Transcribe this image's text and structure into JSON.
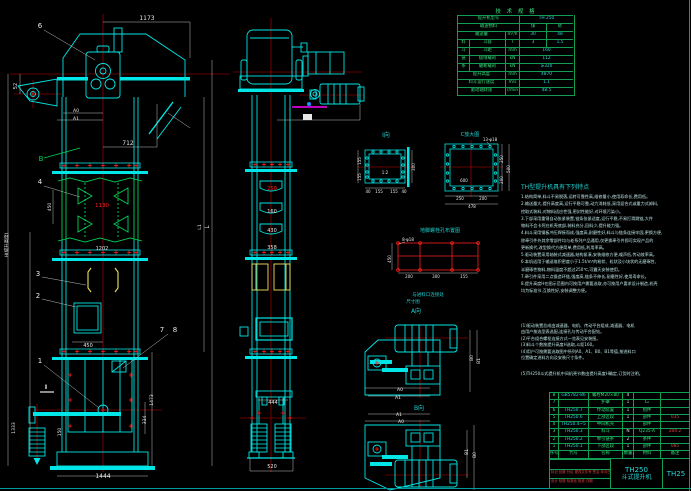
{
  "colors": {
    "background": "#000000",
    "cyan": "#00e5e5",
    "bright_cyan": "#00ffff",
    "green": "#00d455",
    "red": "#ff1e1e",
    "yellow": "#f2e25a",
    "magenta": "#ff00ff",
    "white": "#e8e8e8",
    "table_green": "#129e52"
  },
  "spec_table": {
    "title": "技 术 规 格",
    "rows": [
      [
        {
          "t": "提升机型号",
          "w": 62
        },
        {
          "t": "TH 250",
          "w": 54,
          "c": "cc"
        }
      ],
      [
        {
          "t": "输送物料",
          "w": 62
        },
        {
          "t": "煤",
          "w": 27
        },
        {
          "t": "砂",
          "w": 27
        }
      ],
      [
        {
          "t": "输送量",
          "w": 48
        },
        {
          "t": "m³/h",
          "w": 14
        },
        {
          "t": "30",
          "w": 27,
          "c": "cc"
        },
        {
          "t": "48",
          "w": 27,
          "c": "cc"
        }
      ],
      [
        {
          "t": "料",
          "w": 12
        },
        {
          "t": "斗容",
          "w": 36
        },
        {
          "t": "l",
          "w": 14
        },
        {
          "t": "3",
          "w": 27,
          "c": "cc"
        },
        {
          "t": "1.5",
          "w": 27,
          "c": "cc"
        }
      ],
      [
        {
          "t": "斗",
          "w": 12
        },
        {
          "t": "斗距",
          "w": 36
        },
        {
          "t": "mm",
          "w": 14
        },
        {
          "t": "160",
          "w": 54,
          "c": "cc"
        }
      ],
      [
        {
          "t": "链",
          "w": 12
        },
        {
          "t": "极限载荷",
          "w": 36
        },
        {
          "t": "kN",
          "w": 14
        },
        {
          "t": "112",
          "w": 54,
          "c": "cc"
        }
      ],
      [
        {
          "t": "条",
          "w": 12
        },
        {
          "t": "破断载荷",
          "w": 36
        },
        {
          "t": "kN",
          "w": 14
        },
        {
          "t": "≥320",
          "w": 54,
          "c": "cc"
        }
      ],
      [
        {
          "t": "提升高度",
          "w": 48
        },
        {
          "t": "mm",
          "w": 14
        },
        {
          "t": "4870",
          "w": 54,
          "c": "cc"
        }
      ],
      [
        {
          "t": "料斗运行速度",
          "w": 48
        },
        {
          "t": "m/s",
          "w": 14
        },
        {
          "t": "1.1",
          "w": 54,
          "c": "cc"
        }
      ],
      [
        {
          "t": "驱动轴转速",
          "w": 48
        },
        {
          "t": "r/min",
          "w": 14
        },
        {
          "t": "48.5",
          "w": 54,
          "c": "cc"
        }
      ]
    ]
  },
  "features": {
    "title": "TH型提升机具有下列特点",
    "lines": [
      "1.结构简单,料斗不易脱落,运转可靠性高,维修量小,使用寿命长,费用低。",
      "2.输送量大,提升高度高,运行平稳可靠,动力消耗低,采用混合式或重力式卸料,",
      "  挖取式装料,对物料适应性强,密封性能好,对环境污染小。",
      "3.下部采用重锤自动张紧装置,链条张紧适度,运行平稳,不易打滑跳链,大件",
      "  物料不会卡死在机壳底部,装料充分,回料少,提升能力强。",
      "4.料斗采用钢板冲压焊接而成,强度高,耐磨性好,料斗与链条连接牢固,更换方便,",
      "  除牵引件外其余零部件均与老系列产品通用,仅更换牵引件即可实现产品的",
      "  更新换代,改型换代方便简单,费用低,利用率高。",
      "5.驱动装置采用轴装式减速器,结构紧凑,安装维修方便,噪声低,传动效率高。",
      "6.本机适用于输送堆积密度小于1.5t/m³的粉状、粒状及小块状的无磨琢性、",
      "  半磨琢性物料,物料温度不超过250℃,可露天安装使用。",
      "7.牵引件采用二点锻造环链,强度高,链条不伸长,耐磨性好,使用寿命长。",
      "8.提升高度H在图示范围内可按用户需要选取,亦可按用户要求设计制造,机壳",
      "  均为标准节,互换性好,安装调整方便。"
    ]
  },
  "notes": {
    "lines": [
      "(1)驱动装置总成由减速器、电机、传动平台组成,减速器、电机",
      "  由用户按选型表选配,连接孔与传动平台配钻。",
      "(2)平台组合螺栓连接方式一览表见安装图。",
      "(3)料斗个数按提升高度H选取,斗距160。",
      "(4)用户可按需要选取图中所列A0、A1、B0、B1等值,按进料口",
      "  位置确定进料方向及安装尺寸条件。"
    ],
    "footer": "(5)TH250斗式提升机中间机壳节数由提升高度H确定,订货时注明。"
  },
  "parts_table": {
    "col_widths": [
      9,
      30,
      34,
      11,
      27,
      29
    ],
    "header": [
      "序号",
      "代号",
      "名称",
      "数量",
      "材料",
      "备注"
    ],
    "rows": [
      {
        "cells": [
          "8",
          "GB5782-86",
          "螺栓M20×80",
          "4",
          "",
          ""
        ],
        "colors": [
          "cg",
          "cc",
          "cg",
          "cw",
          "cg",
          "cr"
        ]
      },
      {
        "cells": [
          "7",
          "",
          "护罩",
          "1",
          "L₀",
          ""
        ],
        "colors": [
          "cg",
          "cc",
          "cg",
          "cw",
          "cg",
          "cr"
        ]
      },
      {
        "cells": [
          "6",
          "TH250.7",
          "传动装置",
          "1",
          "组件",
          ""
        ],
        "colors": [
          "cg",
          "cc",
          "cg",
          "cw",
          "cg",
          "cr"
        ]
      },
      {
        "cells": [
          "5",
          "TH250.6",
          "上部区段",
          "1",
          "部件",
          "035"
        ],
        "colors": [
          "cg",
          "cc",
          "cg",
          "cw",
          "cg",
          "cr"
        ]
      },
      {
        "cells": [
          "4",
          "TH250.4~5",
          "中间机壳",
          "",
          "部件",
          ""
        ],
        "colors": [
          "cg",
          "cc",
          "cg",
          "cw",
          "cg",
          "cr"
        ]
      },
      {
        "cells": [
          "3",
          "TH250.3",
          "料斗",
          "N",
          "Q235-A",
          "204 2"
        ],
        "colors": [
          "cg",
          "cc",
          "cg",
          "cw",
          "cg",
          "cr"
        ]
      },
      {
        "cells": [
          "2",
          "TH250.2",
          "牵引链条",
          "2",
          "条件",
          ""
        ],
        "colors": [
          "cg",
          "cc",
          "cg",
          "cw",
          "cg",
          "cr"
        ]
      },
      {
        "cells": [
          "1",
          "TH250.1",
          "下部区段",
          "1",
          "部件",
          "085"
        ],
        "colors": [
          "cg",
          "cc",
          "cg",
          "cw",
          "cg",
          "cr"
        ]
      }
    ]
  },
  "title_block": {
    "model": "TH250",
    "name": "斗式提升机",
    "drawing_no": "TH25",
    "rev_row": "标记 处数 分区 更改文件号 签名 年月日",
    "sign_row": "设计  校核  标准化  批准  日期"
  },
  "labels": [
    {
      "n": "dim-1173",
      "t": "1173",
      "x": 147,
      "y": 20,
      "c": "#e8e8e8",
      "s": 6
    },
    {
      "n": "leader-6-label",
      "t": "6",
      "x": 40,
      "y": 28,
      "c": "#e8e8e8",
      "s": 7
    },
    {
      "n": "dim-52",
      "t": "52",
      "x": 17,
      "y": 86,
      "c": "#e8e8e8",
      "s": 5,
      "r": -90
    },
    {
      "n": "dim-a0-head",
      "t": "A0",
      "x": 76,
      "y": 112,
      "c": "#e8e8e8",
      "s": 4.5
    },
    {
      "n": "dim-a1-head",
      "t": "A1",
      "x": 76,
      "y": 120,
      "c": "#e8e8e8",
      "s": 4.5
    },
    {
      "n": "dim-712",
      "t": "712",
      "x": 128,
      "y": 145,
      "c": "#e8e8e8",
      "s": 6
    },
    {
      "n": "label-b-section",
      "t": "B",
      "x": 41,
      "y": 161,
      "c": "#00d455",
      "s": 7
    },
    {
      "n": "leader-4-label",
      "t": "4",
      "x": 40,
      "y": 184,
      "c": "#e8e8e8",
      "s": 7
    },
    {
      "n": "dim-450-bucket",
      "t": "450",
      "x": 51,
      "y": 207,
      "c": "#e8e8e8",
      "s": 4.5,
      "r": -90
    },
    {
      "n": "dim-1130",
      "t": "1130",
      "x": 102,
      "y": 207,
      "c": "#ff1e1e",
      "s": 5.5
    },
    {
      "n": "dim-1202",
      "t": "1202",
      "x": 102,
      "y": 250,
      "c": "#e8e8e8",
      "s": 5
    },
    {
      "n": "leader-3-label",
      "t": "3",
      "x": 38,
      "y": 276,
      "c": "#e8e8e8",
      "s": 7
    },
    {
      "n": "leader-2-label",
      "t": "2",
      "x": 38,
      "y": 298,
      "c": "#e8e8e8",
      "s": 7
    },
    {
      "n": "dim-450-door",
      "t": "450",
      "x": 88,
      "y": 347,
      "c": "#e8e8e8",
      "s": 5
    },
    {
      "n": "leader-7-label",
      "t": "7",
      "x": 162,
      "y": 332,
      "c": "#e8e8e8",
      "s": 7
    },
    {
      "n": "leader-8-label",
      "t": "8",
      "x": 175,
      "y": 332,
      "c": "#e8e8e8",
      "s": 7
    },
    {
      "n": "leader-1-label",
      "t": "1",
      "x": 40,
      "y": 363,
      "c": "#e8e8e8",
      "s": 7
    },
    {
      "n": "section-ii-label",
      "t": "Ⅱ",
      "x": 46,
      "y": 389,
      "c": "#e8e8e8",
      "s": 6
    },
    {
      "n": "dim-height-h",
      "t": "H(提升高度)",
      "x": 8,
      "y": 245,
      "c": "#e8e8e8",
      "s": 4.5,
      "r": -90
    },
    {
      "n": "dim-1333",
      "t": "1333",
      "x": 15,
      "y": 428,
      "c": "#e8e8e8",
      "s": 4.5,
      "r": -90
    },
    {
      "n": "dim-150",
      "t": "150",
      "x": 61,
      "y": 432,
      "c": "#e8e8e8",
      "s": 4.5,
      "r": -90
    },
    {
      "n": "dim-1473",
      "t": "1473",
      "x": 153,
      "y": 400,
      "c": "#e8e8e8",
      "s": 4.5,
      "r": -90
    },
    {
      "n": "dim-334",
      "t": "334",
      "x": 146,
      "y": 420,
      "c": "#e8e8e8",
      "s": 4.5,
      "r": -90
    },
    {
      "n": "dim-1444",
      "t": "1444",
      "x": 103,
      "y": 478,
      "c": "#e8e8e8",
      "s": 6
    },
    {
      "n": "dim-l-right",
      "t": "L",
      "x": 209,
      "y": 227,
      "c": "#e8e8e8",
      "s": 6,
      "r": -90
    },
    {
      "n": "dim-l1-right",
      "t": "L1",
      "x": 201,
      "y": 227,
      "c": "#e8e8e8",
      "s": 4.5,
      "r": -90
    },
    {
      "n": "dim-250-side",
      "t": "250",
      "x": 272,
      "y": 190,
      "c": "#ff1e1e",
      "s": 5
    },
    {
      "n": "dim-160-side",
      "t": "160",
      "x": 272,
      "y": 213,
      "c": "#e8e8e8",
      "s": 5
    },
    {
      "n": "dim-430-side",
      "t": "430",
      "x": 272,
      "y": 232,
      "c": "#e8e8e8",
      "s": 5
    },
    {
      "n": "dim-358-side",
      "t": "358",
      "x": 272,
      "y": 249,
      "c": "#e8e8e8",
      "s": 5
    },
    {
      "n": "dim-444-side",
      "t": "444",
      "x": 273,
      "y": 404,
      "c": "#e8e8e8",
      "s": 5
    },
    {
      "n": "dim-520-side",
      "t": "520",
      "x": 272,
      "y": 468,
      "c": "#e8e8e8",
      "s": 5
    },
    {
      "n": "view-i-label",
      "t": "Ⅰ向",
      "x": 386,
      "y": 137,
      "c": "#1fd3d3",
      "s": 6
    },
    {
      "n": "view-i-scale",
      "t": "1:2",
      "x": 385,
      "y": 174,
      "c": "#e8e8e8",
      "s": 4
    },
    {
      "n": "dim-155-i-left-a",
      "t": "155",
      "x": 361,
      "y": 161,
      "c": "#e8e8e8",
      "s": 4,
      "r": -90
    },
    {
      "n": "dim-155-i-left-b",
      "t": "155",
      "x": 361,
      "y": 177,
      "c": "#e8e8e8",
      "s": 4,
      "r": -90
    },
    {
      "n": "dim-300-i-right",
      "t": "300",
      "x": 415,
      "y": 167,
      "c": "#e8e8e8",
      "s": 4,
      "r": -90
    },
    {
      "n": "dim-40-i-a",
      "t": "40",
      "x": 368,
      "y": 193,
      "c": "#e8e8e8",
      "s": 4
    },
    {
      "n": "dim-155-i-ba",
      "t": "155",
      "x": 379,
      "y": 193,
      "c": "#e8e8e8",
      "s": 4
    },
    {
      "n": "dim-155-i-bb",
      "t": "155",
      "x": 394,
      "y": 193,
      "c": "#e8e8e8",
      "s": 4
    },
    {
      "n": "dim-40-i-b",
      "t": "40",
      "x": 404,
      "y": 193,
      "c": "#e8e8e8",
      "s": 4
    },
    {
      "n": "view-c-label",
      "t": "C放大图",
      "x": 470,
      "y": 136,
      "c": "#1fd3d3",
      "s": 5
    },
    {
      "n": "label-13-phi18",
      "t": "13-φ18",
      "x": 490,
      "y": 141,
      "c": "#e8e8e8",
      "s": 4
    },
    {
      "n": "dim-600-c",
      "t": "600",
      "x": 464,
      "y": 182,
      "c": "#e8e8e8",
      "s": 4
    },
    {
      "n": "dim-250-c-bottom",
      "t": "250",
      "x": 460,
      "y": 200,
      "c": "#e8e8e8",
      "s": 4
    },
    {
      "n": "dim-200-c-bottom",
      "t": "200",
      "x": 483,
      "y": 200,
      "c": "#e8e8e8",
      "s": 4
    },
    {
      "n": "dim-478-c",
      "t": "478",
      "x": 472,
      "y": 208,
      "c": "#e8e8e8",
      "s": 4
    },
    {
      "n": "dim-250-c-right",
      "t": "250",
      "x": 503,
      "y": 159,
      "c": "#e8e8e8",
      "s": 4,
      "r": -90
    },
    {
      "n": "dim-200-c-right",
      "t": "200",
      "x": 503,
      "y": 180,
      "c": "#e8e8e8",
      "s": 4,
      "r": -90
    },
    {
      "n": "dim-500-c-right",
      "t": "500",
      "x": 510,
      "y": 169,
      "c": "#e8e8e8",
      "s": 4,
      "r": -90
    },
    {
      "n": "anchor-grid-title",
      "t": "地脚螺栓孔布置图",
      "x": 440,
      "y": 232,
      "c": "#1fd3d3",
      "s": 5
    },
    {
      "n": "label-8-phi18",
      "t": "8-φ18",
      "x": 408,
      "y": 241,
      "c": "#e8e8e8",
      "s": 4
    },
    {
      "n": "dim-450-grid",
      "t": "450",
      "x": 391,
      "y": 259,
      "c": "#e8e8e8",
      "s": 4,
      "r": -90
    },
    {
      "n": "dim-200-grid-a",
      "t": "200",
      "x": 409,
      "y": 278,
      "c": "#e8e8e8",
      "s": 4
    },
    {
      "n": "dim-300-grid",
      "t": "300",
      "x": 436,
      "y": 278,
      "c": "#e8e8e8",
      "s": 4
    },
    {
      "n": "dim-155-grid",
      "t": "155",
      "x": 464,
      "y": 278,
      "c": "#e8e8e8",
      "s": 4
    },
    {
      "n": "connect-label-line1",
      "t": "与进料口连接处",
      "x": 428,
      "y": 296,
      "c": "#1fd3d3",
      "s": 4.5
    },
    {
      "n": "connect-label-line2",
      "t": "尺寸图",
      "x": 413,
      "y": 303,
      "c": "#1fd3d3",
      "s": 4.5
    },
    {
      "n": "view-a-label",
      "t": "A向",
      "x": 416,
      "y": 313,
      "c": "#1fd3d3",
      "s": 6
    },
    {
      "n": "view-b-label",
      "t": "B向",
      "x": 419,
      "y": 410,
      "c": "#1fd3d3",
      "s": 6
    },
    {
      "n": "dim-b0-plan-top",
      "t": "B0",
      "x": 473,
      "y": 358,
      "c": "#e8e8e8",
      "s": 4.5,
      "r": -90
    },
    {
      "n": "dim-b1-plan-top",
      "t": "B1",
      "x": 480,
      "y": 361,
      "c": "#e8e8e8",
      "s": 4.5,
      "r": -90
    },
    {
      "n": "dim-a0-plan-top",
      "t": "A0",
      "x": 400,
      "y": 391,
      "c": "#e8e8e8",
      "s": 4.5
    },
    {
      "n": "dim-a1-plan-top",
      "t": "A1",
      "x": 398,
      "y": 399,
      "c": "#e8e8e8",
      "s": 4.5
    },
    {
      "n": "dim-a1-plan-bot",
      "t": "A1",
      "x": 399,
      "y": 416,
      "c": "#e8e8e8",
      "s": 4.5
    },
    {
      "n": "dim-a0-plan-bot",
      "t": "A0",
      "x": 401,
      "y": 423,
      "c": "#e8e8e8",
      "s": 4.5
    },
    {
      "n": "dim-b1-plan-bot",
      "t": "B1",
      "x": 468,
      "y": 452,
      "c": "#e8e8e8",
      "s": 4.5,
      "r": -90
    },
    {
      "n": "dim-b0-plan-bot",
      "t": "B0",
      "x": 476,
      "y": 455,
      "c": "#e8e8e8",
      "s": 4.5,
      "r": -90
    }
  ]
}
